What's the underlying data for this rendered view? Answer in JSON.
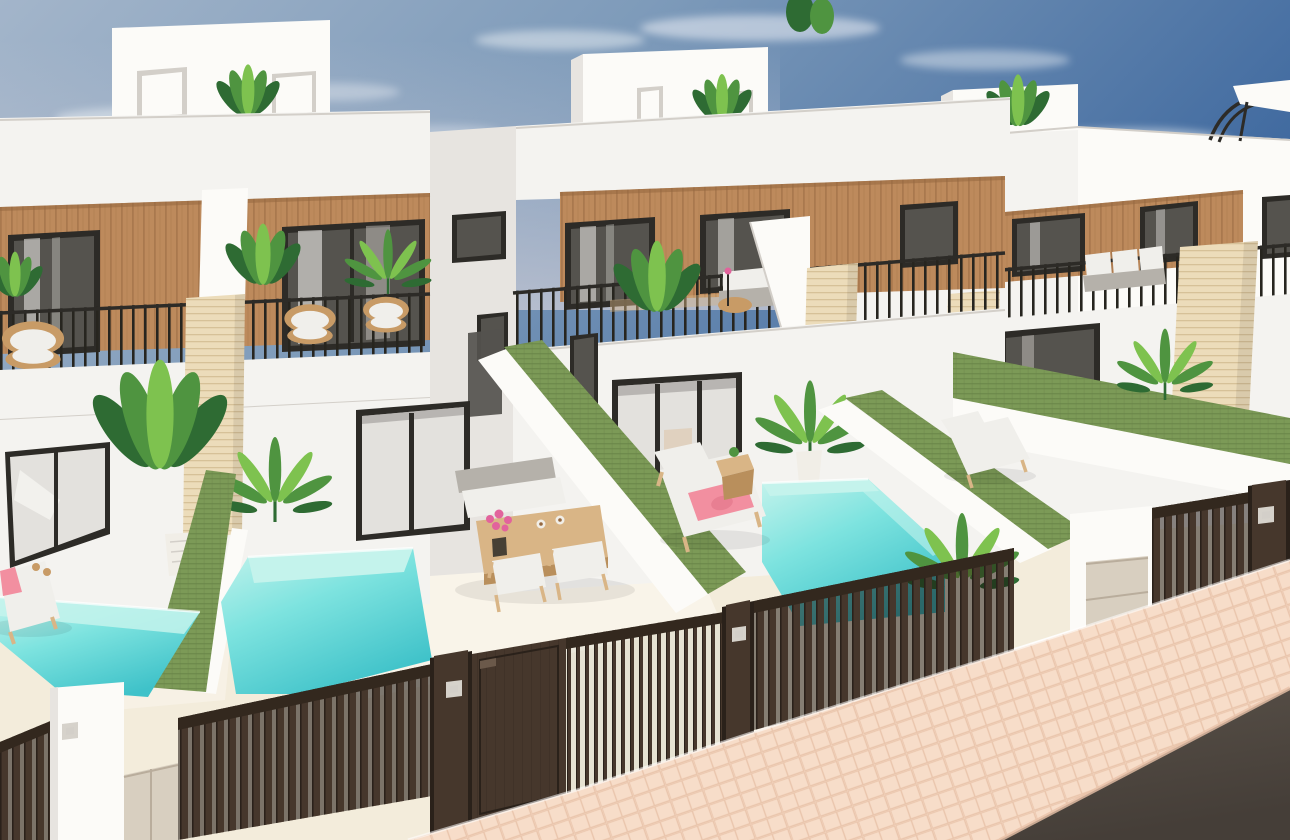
{
  "meta": {
    "media_type": "3d-architectural-render",
    "canvas": {
      "width": 1290,
      "height": 840
    }
  },
  "scene": {
    "label": "3D render of a row of modern white terraced villas with wood-slat facades, green artificial-hedge dividing walls, private turquoise plunge pools and dark slatted street gates",
    "sky": {
      "description": "blue gradient sky, light on the left, deeper blue upper right, wispy clouds",
      "cloud_count": 9
    },
    "buildings": {
      "left_villa": {
        "features": [
          "rooftop-terrace-box",
          "two-roof-terrace-doors",
          "roof-plant",
          "wood-slat-facade",
          "two-framed-windows",
          "balcony-railing",
          "three-wicker-armchairs",
          "white-chimney-column",
          "travertine-column",
          "corner-glass-door",
          "double-glass-door",
          "bird-of-paradise-plant",
          "bamboo-plant"
        ]
      },
      "middle_villa": {
        "features": [
          "rooftop-terrace-box",
          "roof-terrace-doors",
          "roof-plant",
          "wood-slat-facade",
          "curtained-windows",
          "terrace-railing",
          "outdoor-sofa",
          "round-wicker-table",
          "terrace-plants",
          "travertine-column",
          "triple-glass-door",
          "potted-palm"
        ]
      },
      "right_villas": {
        "features": [
          "rooftop-terrace-box",
          "roof-pergola-with-canopy",
          "wood-slat-facade",
          "framed-windows",
          "balcony-railing",
          "outdoor-sofa-cushions",
          "travertine-column",
          "beige-stone-column",
          "ground-floor-glass-doors"
        ]
      }
    },
    "yards": [
      {
        "name": "neighbor-yard",
        "objects": [
          "plunge-pool",
          "sun-lounger",
          "pink-towel",
          "potted-bird-of-paradise"
        ]
      },
      {
        "name": "left-villa-yard",
        "objects": [
          "plunge-pool",
          "wooden-dining-table",
          "bench-with-white-cushions",
          "two-wooden-chairs",
          "pink-flower-bouquet",
          "two-coffee-cups"
        ]
      },
      {
        "name": "middle-villa-yard",
        "objects": [
          "plunge-pool",
          "wooden-sun-lounger",
          "pink-towel-and-paddle",
          "wooden-side-table",
          "potted-palm"
        ]
      },
      {
        "name": "right-villa-yard",
        "objects": [
          "sun-lounger",
          "artificial-grass-dividing-walls",
          "palm-plant"
        ]
      }
    ],
    "dividers": [
      "green-hedge-wall-left",
      "green-hedge-wall-center",
      "green-hedge-wall-right",
      "green-hedge-wall-far-right"
    ],
    "street": {
      "elements": [
        "dark-slatted-fence-sections",
        "solid-entrance-door",
        "slatted-driveway-gate",
        "white-gate-pillar-with-keypad",
        "beige-utility-doors",
        "dark-gate-pillars",
        "herringbone-paved-sidewalk",
        "asphalt-road"
      ]
    }
  },
  "palette": {
    "sky_left": "#a3b5ca",
    "sky_mid": "#7e9bba",
    "sky_right": "#3f699f",
    "horizon": "#ccccd6",
    "cloud": "#eef1f6",
    "wall": "#f4f3f0",
    "wall_bright": "#fcfbf8",
    "wall_shade": "#e7e4e0",
    "wall_dark": "#d3cfc9",
    "wood": "#bd8a5c",
    "wood_line": "#96683f",
    "frame": "#2d2b27",
    "glass": "#a5a3a0",
    "glass_light": "#e3e1dd",
    "glass_dark": "#55534e",
    "travertine": "#ecdcba",
    "travertine_line": "#d2bc92",
    "hedge": "#7c9a57",
    "hedge_line": "#647f45",
    "pool_light": "#c4f3ec",
    "pool_mid": "#7de3df",
    "pool_deep": "#3fc2c9",
    "fence": "#46372c",
    "fence_dark": "#2a211a",
    "fence_beam": "#33281e",
    "floor": "#f3ecdb",
    "floor_bright": "#faf6ec",
    "paving": "#f7ddc9",
    "paving_line": "#e8c2a9",
    "road": "#595149",
    "road_dark": "#453e38",
    "plant": "#4f9440",
    "plant_dark": "#2e6b33",
    "plant_light": "#7ec24f",
    "wicker": "#c89b66",
    "cushion": "#f0efeb",
    "cushion_gray": "#b5b1aa",
    "towel": "#f28fa0",
    "flower": "#e2639c",
    "furn_wood": "#d9b586",
    "furn_wood_dark": "#b98f5c",
    "pot_white": "#f1eee7",
    "utility_door": "#d8cfc0",
    "keypad": "#d6d2cb"
  }
}
